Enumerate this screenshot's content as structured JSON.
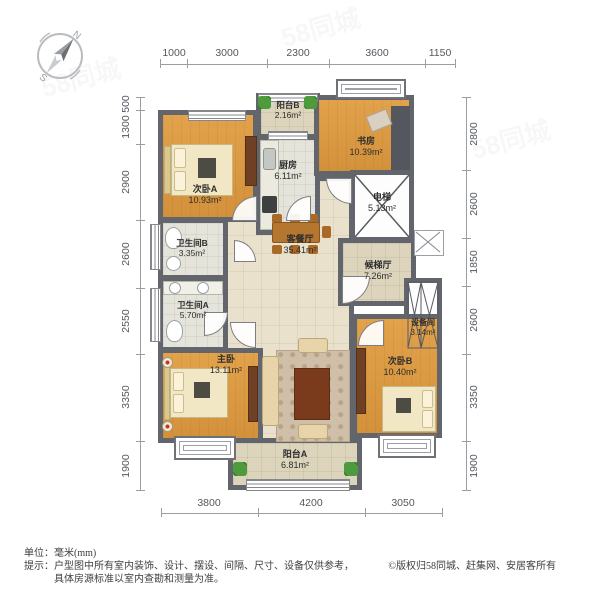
{
  "compass": {
    "north": "N",
    "south": "S"
  },
  "dimensions": {
    "top": [
      "1000",
      "3000",
      "2300",
      "3600",
      "1150"
    ],
    "bottom": [
      "3800",
      "4200",
      "3050"
    ],
    "left": [
      "500",
      "1300",
      "2900",
      "2600",
      "2550",
      "3350",
      "1900"
    ],
    "right": [
      "2800",
      "2600",
      "1850",
      "2600",
      "3350",
      "1900"
    ]
  },
  "rooms": {
    "bedroom_a": {
      "name": "次卧A",
      "area": "10.93m²"
    },
    "balcony_b": {
      "name": "阳台B",
      "area": "2.16m²"
    },
    "kitchen": {
      "name": "厨房",
      "area": "6.11m²"
    },
    "study": {
      "name": "书房",
      "area": "10.39m²"
    },
    "elevator": {
      "name": "电梯",
      "area": "5.13m²"
    },
    "bathroom_b": {
      "name": "卫生间B",
      "area": "3.35m²"
    },
    "living_dining": {
      "name": "客餐厅",
      "area": "35.41m²"
    },
    "elevator_lobby": {
      "name": "候梯厅",
      "area": "7.26m²"
    },
    "bathroom_a": {
      "name": "卫生间A",
      "area": "5.70m²"
    },
    "equipment": {
      "name": "设备间",
      "area": "3.14m²"
    },
    "master_bedroom": {
      "name": "主卧",
      "area": "13.11m²"
    },
    "bedroom_b": {
      "name": "次卧B",
      "area": "10.40m²"
    },
    "balcony_a": {
      "name": "阳台A",
      "area": "6.81m²"
    }
  },
  "footer": {
    "unit_label": "单位：",
    "unit_value": "毫米(mm)",
    "tip_label": "提示：",
    "tip_line1": "户型图中所有室内装饰、设计、摆设、间隔、尺寸、设备仅供参考，",
    "tip_line2": "具体房源标准以室内查勘和测量为准。",
    "copyright": "©版权归58同城、赶集网、安居客所有"
  },
  "watermark": "58同城",
  "colors": {
    "wall": "#63656c",
    "wood": "#d99a42",
    "tile": "#e9e1cb",
    "furniture_wood": "#6f4023"
  }
}
